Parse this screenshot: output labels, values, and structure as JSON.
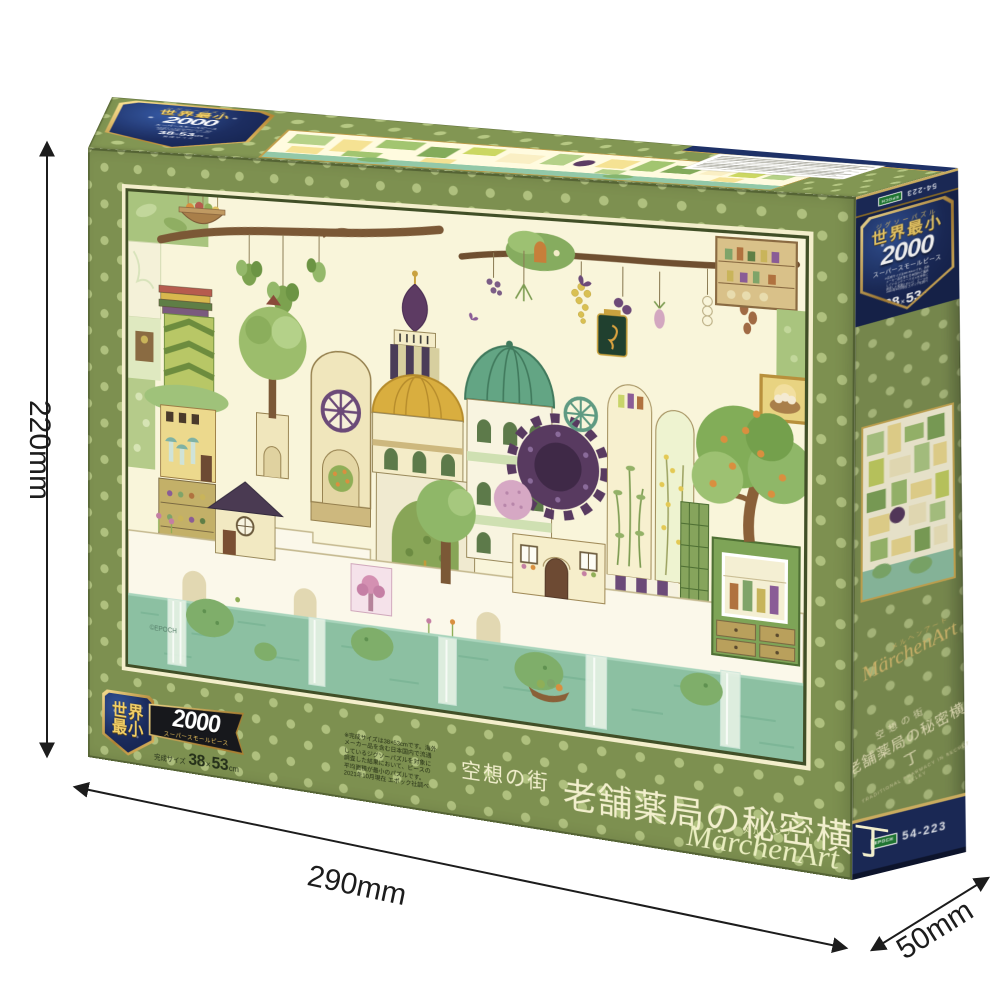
{
  "photo": {
    "alt": "EPOCH jigsaw puzzle box product photo with size annotations"
  },
  "dimensions": {
    "height": "220mm",
    "width": "290mm",
    "depth": "50mm"
  },
  "brand": {
    "latin": "MärchenArt",
    "kana": "メルヘンアート",
    "maker": "EPOCH",
    "item_code": "54-223",
    "art_copyright": "©EPOCH"
  },
  "title": {
    "prefix": "空想の街",
    "main": "老舗薬局の秘密横丁",
    "english": "TRADITIONAL PHARMACY IN SECRET ALLEY"
  },
  "badge": {
    "jigsaw_label": "ジグソーパズル",
    "claim": "世界最小",
    "claim_line1": "世界",
    "claim_line2": "最小",
    "piece_count": "2000",
    "piece_type": "スーパースモールピース",
    "size_caption": "完成サイズ",
    "size_w": "38",
    "size_x": "×",
    "size_h": "53",
    "size_unit": "cm",
    "fine_print": [
      "※完成サイズは38×53cmです。海外",
      "メーカー品を含む日本国内で流通",
      "しているジグソーパズルを対象に",
      "調査した結果において、ピースの",
      "平均面積が最小のパズルです。",
      "2021年10月現在 エポック社調べ"
    ]
  }
}
